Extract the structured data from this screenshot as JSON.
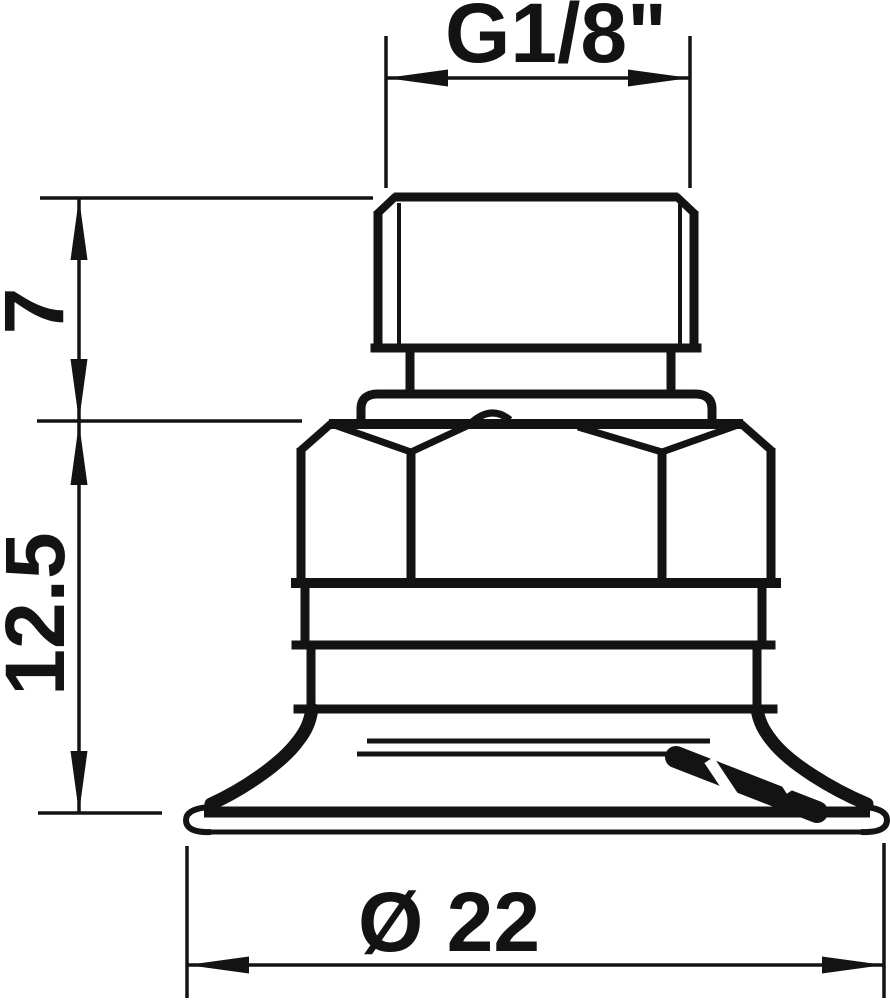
{
  "drawing": {
    "background": "#ffffff",
    "line_color": "#131313",
    "dimensions": {
      "thread_size": {
        "label": "G1/8\""
      },
      "fitting_height": {
        "label": "7"
      },
      "cup_height": {
        "label": "12.5"
      },
      "cup_diameter": {
        "label": "Ø 22"
      }
    }
  }
}
